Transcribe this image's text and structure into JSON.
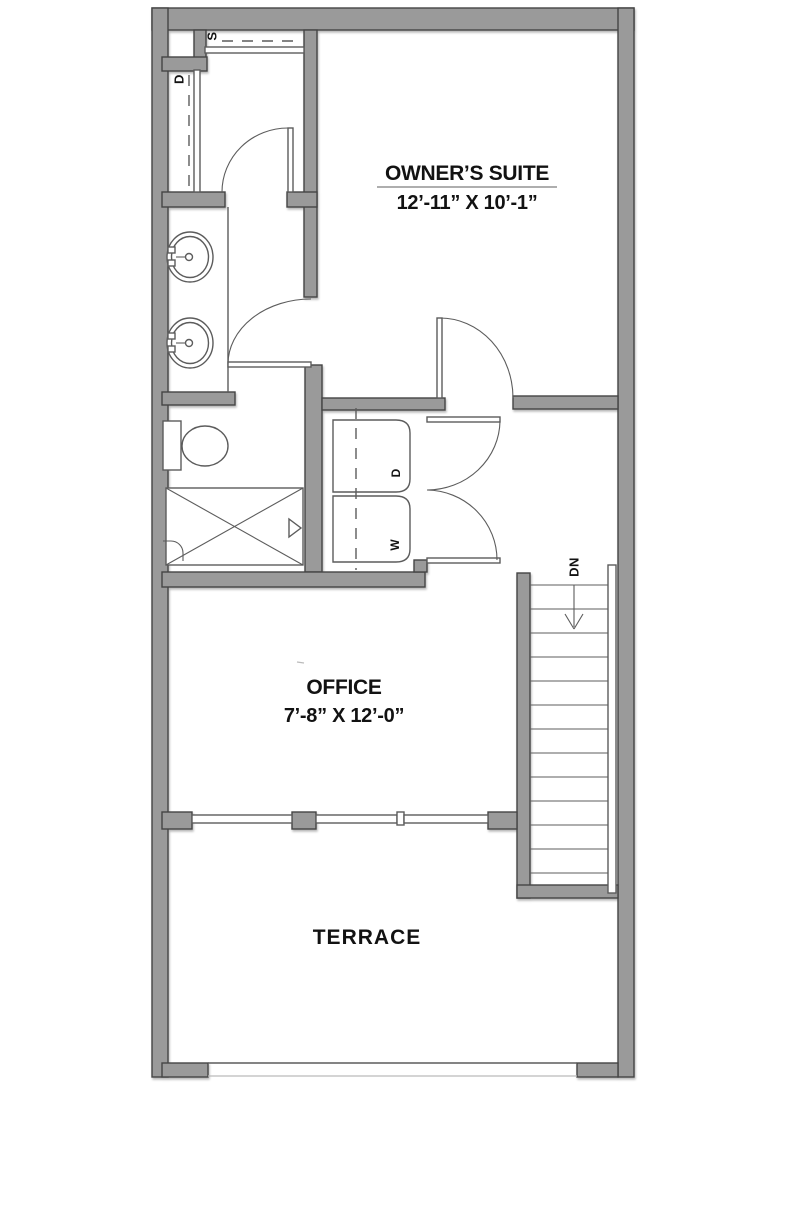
{
  "colors": {
    "wall_fill": "#9a9a9a",
    "wall_stroke": "#454545",
    "line": "#5c5c5c",
    "text": "#121212",
    "bg": "#ffffff",
    "faint": "#bbbbbb"
  },
  "rooms": {
    "owners_suite": {
      "name": "OWNER’S SUITE",
      "dimensions": "12’-11” X 10’-1”"
    },
    "office": {
      "name": "OFFICE",
      "dimensions": "7’-8” X 12’-0”"
    },
    "terrace": {
      "name": "TERRACE"
    }
  },
  "labels": {
    "stair_direction": "DN",
    "washer": "W",
    "dryer": "D",
    "closet_shelf": "S",
    "closet_linen": "D"
  }
}
